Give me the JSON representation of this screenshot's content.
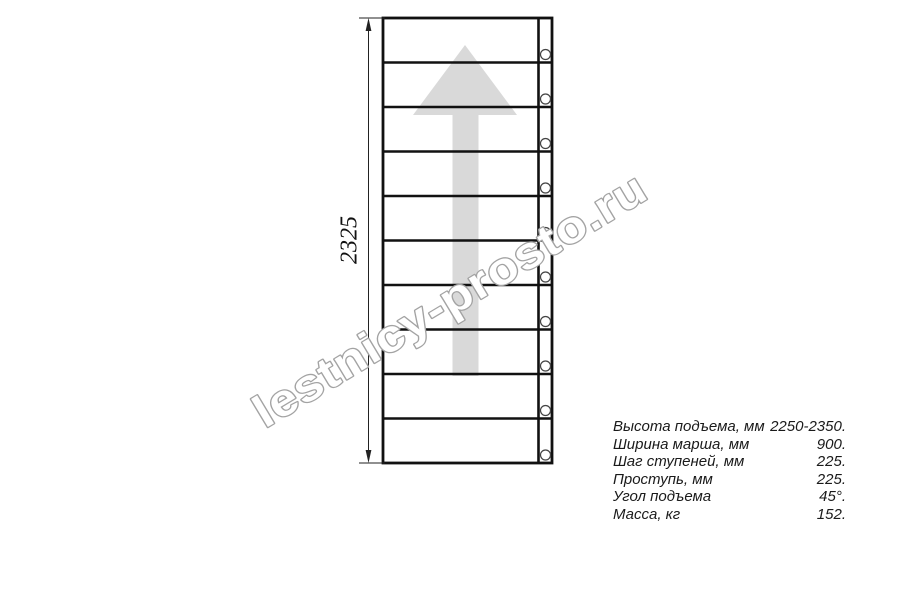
{
  "drawing": {
    "dimension_label": "2325",
    "steps_count": 10,
    "balusters_count": 10
  },
  "watermark": {
    "text": "lestnicy-prosto.ru"
  },
  "specs": {
    "rows": [
      {
        "label": "Высота подъема, мм",
        "value": "2250-2350."
      },
      {
        "label": "Ширина марша, мм",
        "value": "900."
      },
      {
        "label": "Шаг ступеней, мм",
        "value": "225."
      },
      {
        "label": "Проступь, мм",
        "value": "225."
      },
      {
        "label": "Угол подъема",
        "value": "45°."
      },
      {
        "label": "Масса, кг",
        "value": "152."
      }
    ]
  },
  "colors": {
    "background": "#ffffff",
    "line": "#111111",
    "dimension_line": "#222222",
    "direction_arrow_fill": "#d9d9d9",
    "watermark_fill": "#ffffff",
    "watermark_stroke": "#a3a3a3"
  }
}
